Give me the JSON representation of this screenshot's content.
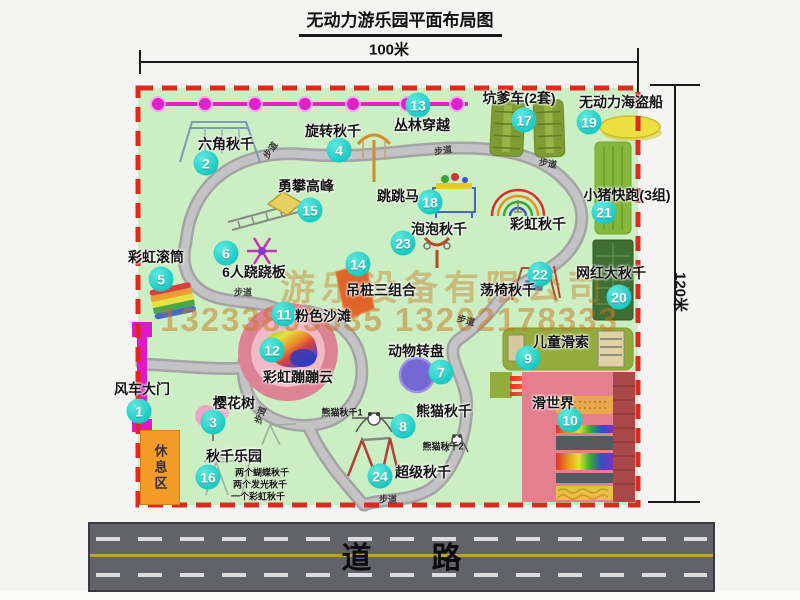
{
  "title": "无动力游乐园平面布局图",
  "dimensions": {
    "width_label": "100米",
    "height_label": "120米"
  },
  "road": {
    "label": "道　　路"
  },
  "rest_area": {
    "label": "休息区"
  },
  "watermark": {
    "line1": "游乐设备有限公司",
    "line2": "13233805635 13202178333"
  },
  "path_label": "步道",
  "items": [
    {
      "num": "1",
      "label": "风车大门",
      "lx": 142,
      "ly": 389,
      "cx": 139,
      "cy": 411
    },
    {
      "num": "2",
      "label": "六角秋千",
      "lx": 226,
      "ly": 144,
      "cx": 206,
      "cy": 163
    },
    {
      "num": "3",
      "label": "樱花树",
      "lx": 234,
      "ly": 403,
      "cx": 213,
      "cy": 422
    },
    {
      "num": "4",
      "label": "旋转秋千",
      "lx": 333,
      "ly": 131,
      "cx": 339,
      "cy": 150
    },
    {
      "num": "5",
      "label": "彩虹滚筒",
      "lx": 156,
      "ly": 257,
      "cx": 161,
      "cy": 279
    },
    {
      "num": "6",
      "label": "6人跷跷板",
      "lx": 254,
      "ly": 272,
      "cx": 226,
      "cy": 253
    },
    {
      "num": "7",
      "label": "动物转盘",
      "lx": 416,
      "ly": 351,
      "cx": 441,
      "cy": 372
    },
    {
      "num": "8",
      "label": "熊猫秋千",
      "lx": 444,
      "ly": 411,
      "cx": 403,
      "cy": 426
    },
    {
      "num": "9",
      "label": "儿童滑索",
      "lx": 561,
      "ly": 342,
      "cx": 528,
      "cy": 358
    },
    {
      "num": "10",
      "label": "滑世界",
      "lx": 553,
      "ly": 403,
      "cx": 570,
      "cy": 420
    },
    {
      "num": "11",
      "label": "粉色沙滩",
      "lx": 323,
      "ly": 316,
      "cx": 284,
      "cy": 314
    },
    {
      "num": "12",
      "label": "彩虹蹦蹦云",
      "lx": 298,
      "ly": 377,
      "cx": 272,
      "cy": 350
    },
    {
      "num": "13",
      "label": "丛林穿越",
      "lx": 422,
      "ly": 125,
      "cx": 418,
      "cy": 105
    },
    {
      "num": "14",
      "label": "吊桩三组合",
      "lx": 381,
      "ly": 290,
      "cx": 358,
      "cy": 264
    },
    {
      "num": "15",
      "label": "勇攀高峰",
      "lx": 306,
      "ly": 186,
      "cx": 310,
      "cy": 210
    },
    {
      "num": "16",
      "label": "秋千乐园",
      "lx": 234,
      "ly": 456,
      "cx": 208,
      "cy": 477
    },
    {
      "num": "17",
      "label": "坑爹车(2套)",
      "lx": 519,
      "ly": 98,
      "cx": 524,
      "cy": 120
    },
    {
      "num": "18",
      "label": "跳跳马",
      "lx": 398,
      "ly": 196,
      "cx": 430,
      "cy": 202
    },
    {
      "num": "19",
      "label": "无动力海盗船",
      "lx": 621,
      "ly": 102,
      "cx": 589,
      "cy": 122
    },
    {
      "num": "20",
      "label": "网红大秋千",
      "lx": 611,
      "ly": 273,
      "cx": 619,
      "cy": 297
    },
    {
      "num": "21",
      "label": "小猪快跑(3组)",
      "lx": 627,
      "ly": 195,
      "cx": 604,
      "cy": 212
    },
    {
      "num": "22",
      "label": "荡椅秋千",
      "lx": 508,
      "ly": 290,
      "cx": 540,
      "cy": 274
    },
    {
      "num": "23",
      "label": "泡泡秋千",
      "lx": 439,
      "ly": 229,
      "cx": 403,
      "cy": 243
    },
    {
      "num": "24",
      "label": "超级秋千",
      "lx": 423,
      "ly": 472,
      "cx": 380,
      "cy": 476
    },
    {
      "num": "",
      "label": "彩虹秋千",
      "lx": 538,
      "ly": 224,
      "cx": 0,
      "cy": 0
    }
  ],
  "notes": [
    {
      "t": "熊猫秋千1",
      "x": 342,
      "y": 412,
      "r": 0
    },
    {
      "t": "熊猫秋千2",
      "x": 443,
      "y": 446,
      "r": 0
    },
    {
      "t": "两个蝴蝶秋千",
      "x": 262,
      "y": 472,
      "r": 0
    },
    {
      "t": "两个发光秋千",
      "x": 260,
      "y": 484,
      "r": 0
    },
    {
      "t": "一个彩虹秋千",
      "x": 258,
      "y": 496,
      "r": 0
    }
  ],
  "path_labels": [
    {
      "x": 270,
      "y": 150,
      "r": -55
    },
    {
      "x": 443,
      "y": 150,
      "r": -8
    },
    {
      "x": 548,
      "y": 163,
      "r": 10
    },
    {
      "x": 243,
      "y": 292,
      "r": 0
    },
    {
      "x": 260,
      "y": 415,
      "r": -70
    },
    {
      "x": 466,
      "y": 320,
      "r": 15
    },
    {
      "x": 388,
      "y": 499,
      "r": 0
    }
  ]
}
